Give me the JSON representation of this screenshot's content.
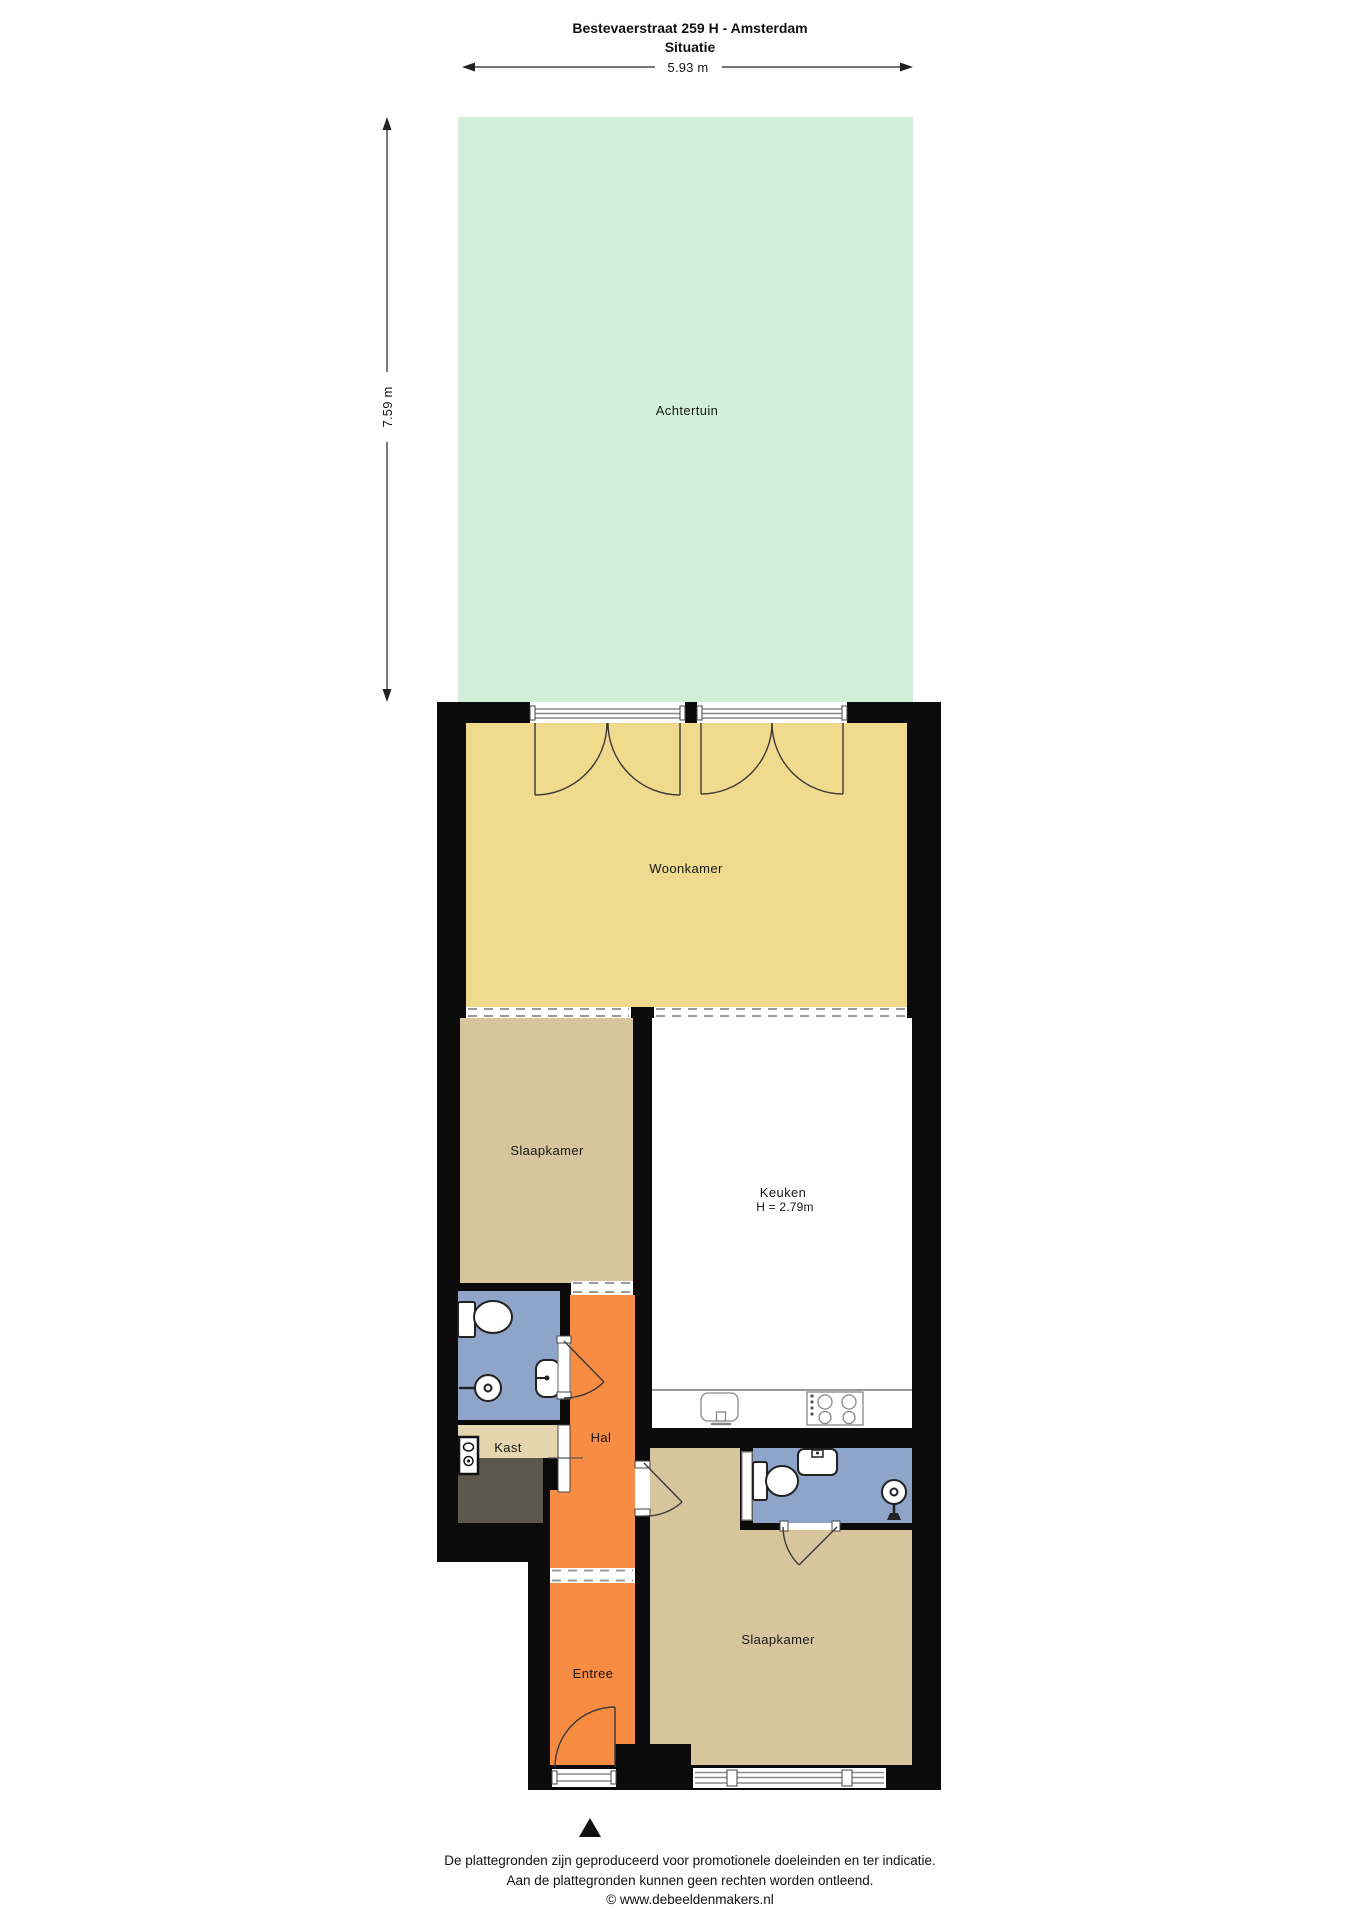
{
  "header": {
    "title": "Bestevaerstraat 259 H - Amsterdam",
    "subtitle": "Situatie"
  },
  "dimensions": {
    "width": "5.93 m",
    "depth": "7.59 m"
  },
  "garden": {
    "label": "Achtertuin"
  },
  "rooms": {
    "woonkamer": {
      "label": "Woonkamer"
    },
    "slaapkamer_1": {
      "label": "Slaapkamer"
    },
    "keuken": {
      "label": "Keuken",
      "ceiling_height": "H = 2.79m"
    },
    "hal": {
      "label": "Hal"
    },
    "kast": {
      "label": "Kast"
    },
    "entree": {
      "label": "Entree"
    },
    "slaapkamer_2": {
      "label": "Slaapkamer"
    }
  },
  "footer": {
    "disclaimer_line1": "De plattegronden zijn geproduceerd voor promotionele doeleinden en ter indicatie.",
    "disclaimer_line2": "Aan de plattegronden kunnen geen rechten worden ontleend.",
    "credit": "© www.debeeldenmakers.nl"
  },
  "colors": {
    "wall": "#0b0b0b",
    "garden": "#d2f0d9",
    "woonkamer": "#f0da8d",
    "slaapkamer": "#d7c69d",
    "keuken": "#ffffff",
    "hallway": "#f78c42",
    "bathroom": "#8ea5c9",
    "kast_light": "#e4d6ae",
    "kast_dark": "#5e584c"
  }
}
